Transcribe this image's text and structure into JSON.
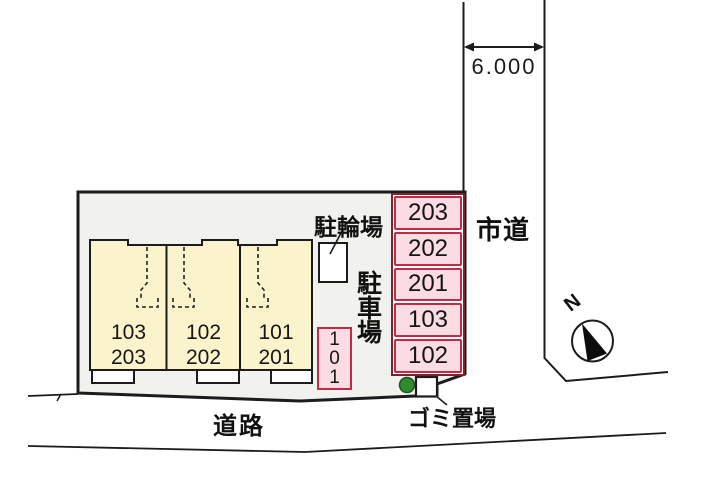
{
  "plan": {
    "dimension": "6.000",
    "city_road": "市道",
    "road": "道路",
    "bicycle_parking": "駐輪場",
    "garbage": "ゴミ置場",
    "north": "N",
    "parking_area_chars": [
      "駐",
      "車",
      "場"
    ],
    "parking_stalls": [
      "203",
      "202",
      "201",
      "103",
      "102"
    ],
    "stall_101_chars": [
      "1",
      "0",
      "1"
    ],
    "building_units": [
      {
        "line1": "103",
        "line2": "203"
      },
      {
        "line1": "102",
        "line2": "202"
      },
      {
        "line1": "101",
        "line2": "201"
      }
    ]
  },
  "colors": {
    "site_gray": "#f1f1ee",
    "building_cream": "#faf3cb",
    "stall_pink": "#fadce2",
    "stall_border": "#c22b45",
    "stall_border_dark": "#7e2230",
    "tree_green": "#2e8b2e",
    "tree_green_dark": "#1c541c",
    "line_black": "#1c1c1c",
    "road_bg": "#ffffff"
  }
}
